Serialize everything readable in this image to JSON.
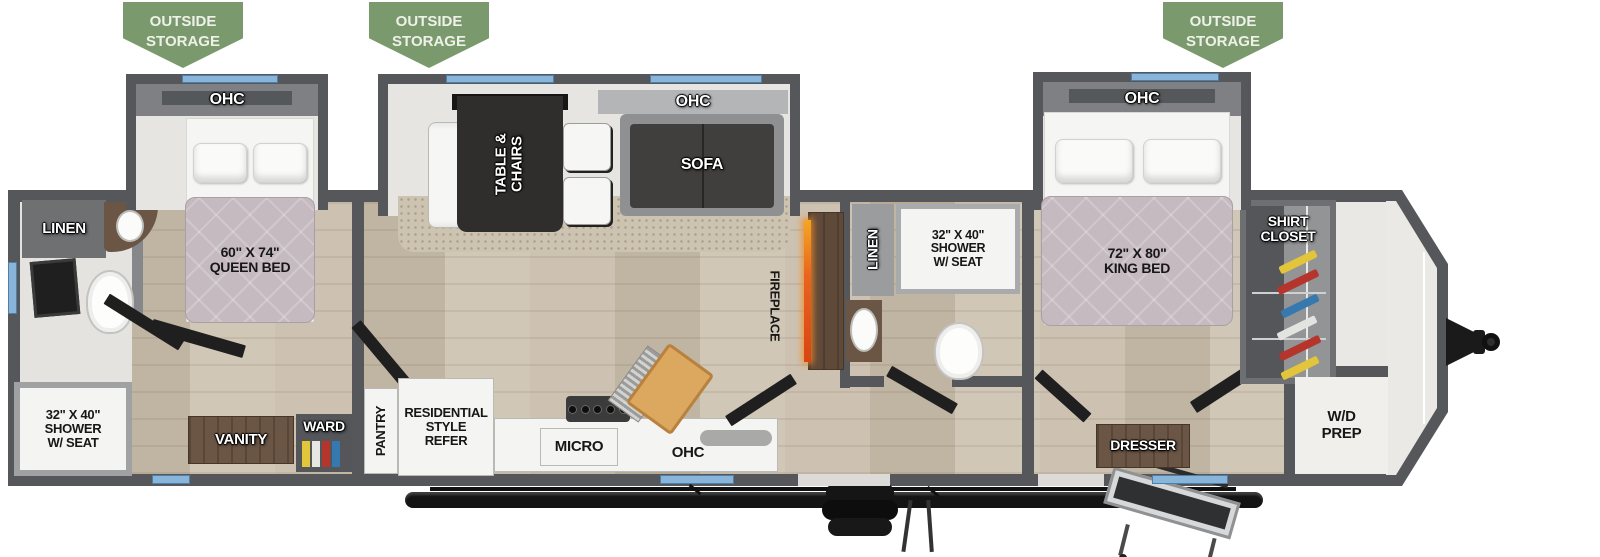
{
  "colors": {
    "wall": "#56575b",
    "wall_light": "#85878a",
    "banner_green": "#7a9a6d",
    "window_blue": "#8ab5da",
    "floor_wood": "#c9beae",
    "mattress": "#c6bac1",
    "wood": "#6b5646",
    "dark": "#232322",
    "slide_floor": "#e6e5e2",
    "flame_orange": "#e8641e"
  },
  "banners": {
    "line1": "OUTSIDE",
    "line2": "STORAGE"
  },
  "labels": {
    "ohc": "OHC",
    "linen": "LINEN",
    "queen_bed": {
      "size": "60\" X 74\"",
      "name": "QUEEN BED"
    },
    "king_bed": {
      "size": "72\" X 80\"",
      "name": "KING BED"
    },
    "shower": {
      "size": "32\" X 40\"",
      "line2": "SHOWER",
      "line3": "W/ SEAT"
    },
    "table_chairs": {
      "line1": "TABLE &",
      "line2": "CHAIRS"
    },
    "sofa": "SOFA",
    "fireplace": "FIREPLACE",
    "vanity": "VANITY",
    "ward": "WARD",
    "pantry": "PANTRY",
    "refer": {
      "line1": "RESIDENTIAL",
      "line2": "STYLE",
      "line3": "REFER"
    },
    "micro": "MICRO",
    "dresser": "DRESSER",
    "shirt_closet": {
      "line1": "SHIRT",
      "line2": "CLOSET"
    },
    "wd_prep": {
      "line1": "W/D",
      "line2": "PREP"
    }
  }
}
